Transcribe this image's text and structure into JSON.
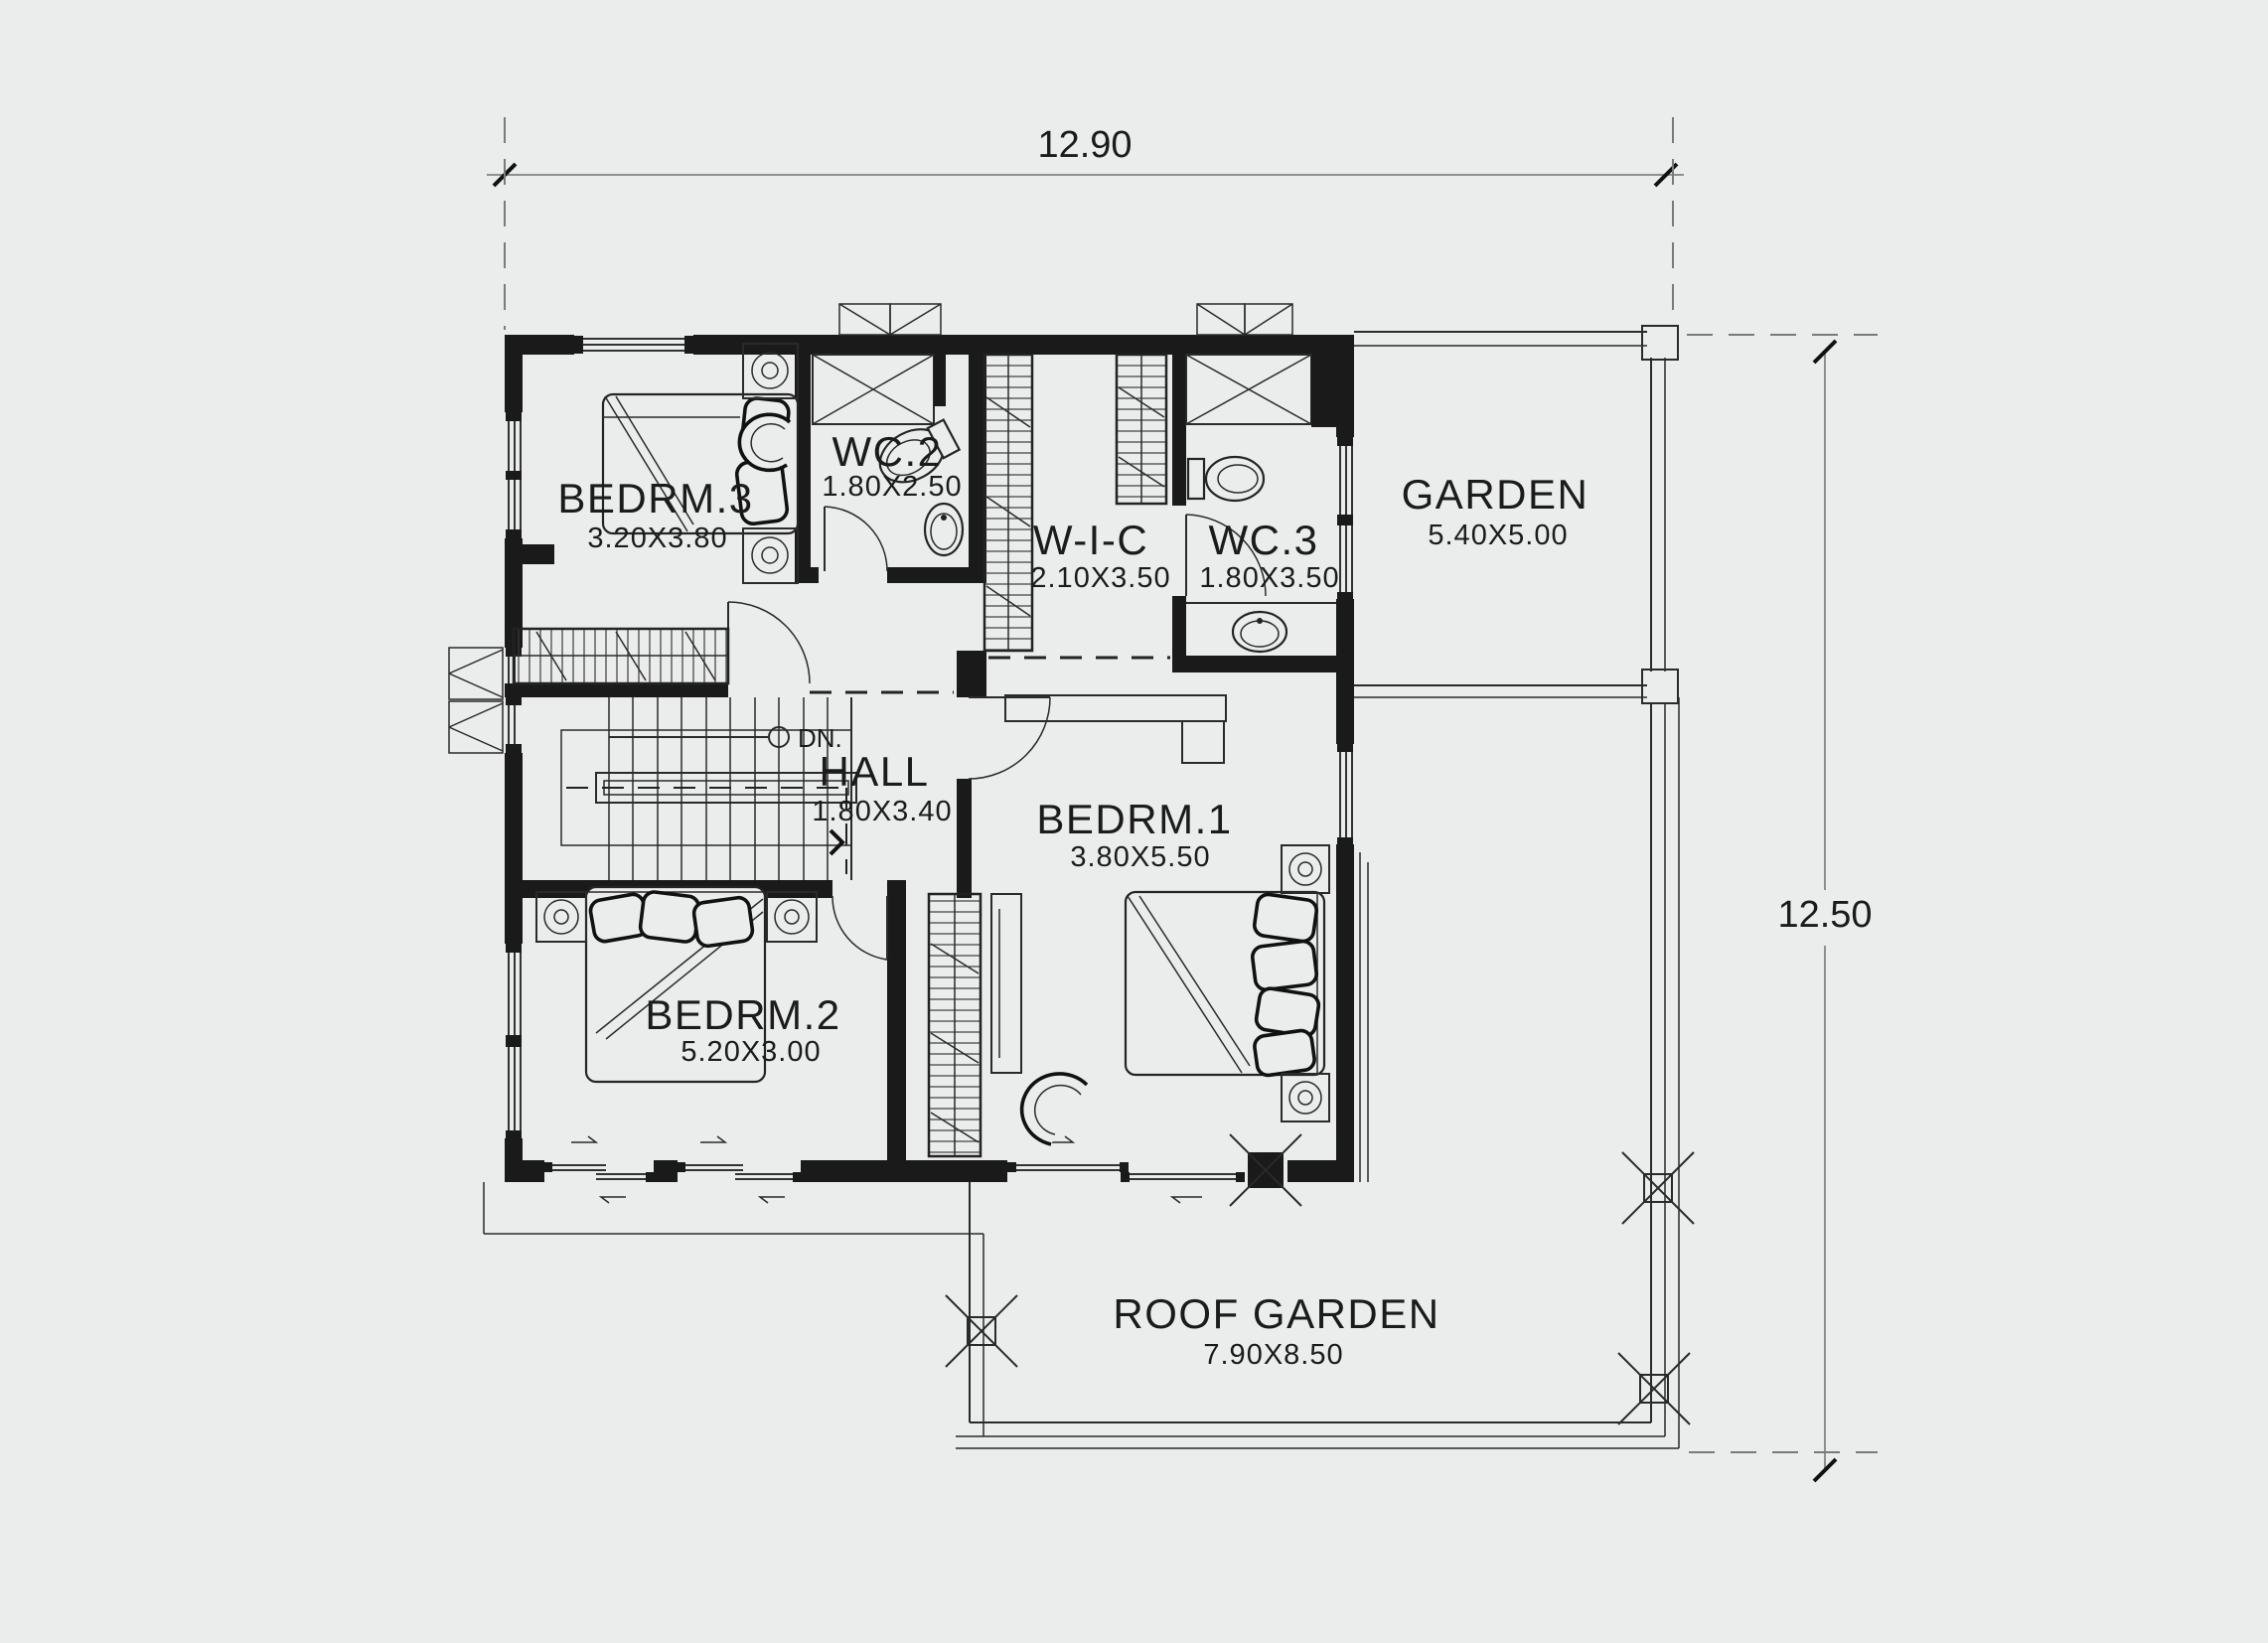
{
  "theme": {
    "background": "#ebecec",
    "ink": "#1b1b1b",
    "light_line": "#8f8f8f"
  },
  "dimensions": {
    "top_width": "12.90",
    "right_height": "12.50"
  },
  "stairs": {
    "direction_label": "DN."
  },
  "rooms": {
    "bedrm3": {
      "name": "BEDRM.3",
      "size": "3.20X3.80"
    },
    "wc2": {
      "name": "WC.2",
      "size": "1.80X2.50"
    },
    "wic": {
      "name": "W-I-C",
      "size": "2.10X3.50"
    },
    "wc3": {
      "name": "WC.3",
      "size": "1.80X3.50"
    },
    "garden": {
      "name": "GARDEN",
      "size": "5.40X5.00"
    },
    "hall": {
      "name": "HALL",
      "size": "1.80X3.40"
    },
    "bedrm1": {
      "name": "BEDRM.1",
      "size": "3.80X5.50"
    },
    "bedrm2": {
      "name": "BEDRM.2",
      "size": "5.20X3.00"
    },
    "roof_garden": {
      "name": "ROOF GARDEN",
      "size": "7.90X8.50"
    }
  }
}
